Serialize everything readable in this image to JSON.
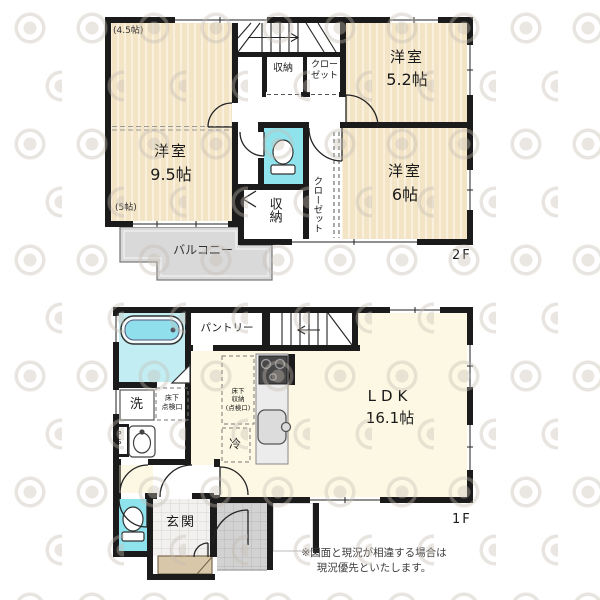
{
  "floor2": {
    "label": "2F",
    "room95": {
      "name": "洋室",
      "size": "9.5帖",
      "upper": "(4.5帖)",
      "lower": "(5帖)"
    },
    "room52": {
      "name": "洋室",
      "size": "5.2帖"
    },
    "room6": {
      "name": "洋室",
      "size": "6帖"
    },
    "storage_upper": "収納",
    "closet_upper_line1": "クロー",
    "closet_upper_line2": "ゼット",
    "storage_lower": "収納",
    "closet_side": "クローゼット",
    "balcony": "バルコニー"
  },
  "floor1": {
    "label": "1F",
    "ldk": {
      "name": "LDK",
      "size": "16.1帖"
    },
    "pantry": "パントリー",
    "entrance": "玄関",
    "washer": "洗",
    "fridge": "冷",
    "pipe_space": "PS",
    "hatch": {
      "line1": "床下",
      "line2": "点検口"
    },
    "floor_storage": {
      "line1": "床下",
      "line2": "収納",
      "line3": "(点検口)"
    }
  },
  "notes": {
    "disclaimer_line1": "※図面と現況が相違する場合は",
    "disclaimer_line2": "現況優先といたします。"
  }
}
